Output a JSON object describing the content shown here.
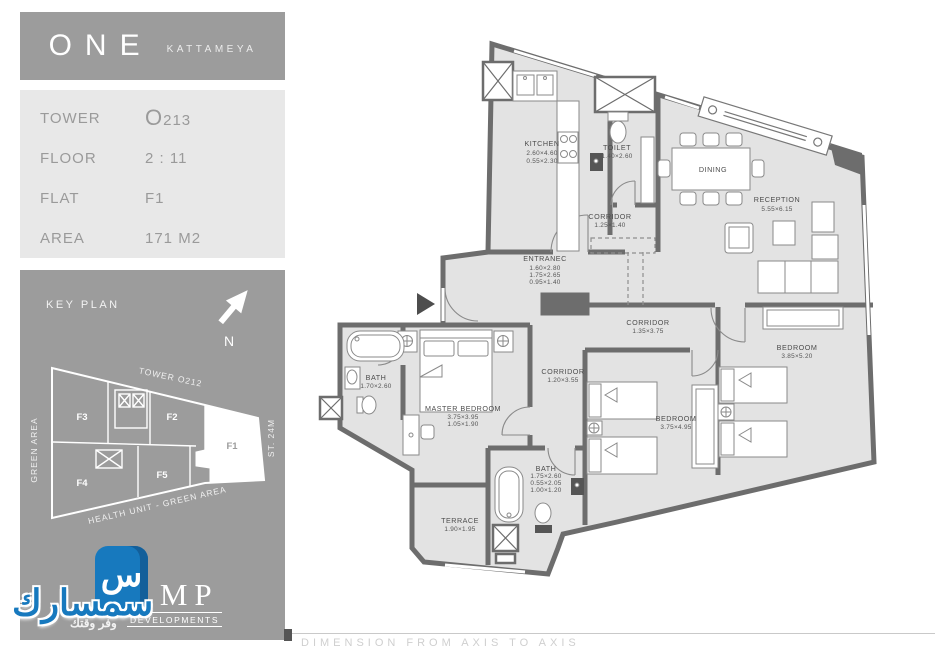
{
  "brand": {
    "title": "ONE",
    "subtitle": "KATTAMEYA"
  },
  "info": {
    "rows": [
      {
        "label": "TOWER",
        "value": "O213"
      },
      {
        "label": "FLOOR",
        "value": "2  :  11"
      },
      {
        "label": "FLAT",
        "value": "F1"
      },
      {
        "label": "AREA",
        "value": "171  M2"
      }
    ]
  },
  "key_plan": {
    "title": "KEY PLAN",
    "north": "N",
    "labels": {
      "top": "TOWER  O212",
      "left": "GREEN  AREA",
      "right": "ST.  24M",
      "bottom": "HEALTH  UNIT  -  GREEN  AREA"
    },
    "flats": [
      "F3",
      "F2",
      "F1",
      "F4",
      "F5"
    ],
    "highlighted_flat": "F1"
  },
  "floor_plan": {
    "rooms": [
      {
        "name": "KITCHEN",
        "dims": [
          "2.60×4.60",
          "0.55×2.30"
        ]
      },
      {
        "name": "TOILET",
        "dims": [
          "1.40×2.60"
        ]
      },
      {
        "name": "CORRIDOR",
        "dims": [
          "1.25×1.40"
        ]
      },
      {
        "name": "DINING",
        "dims": []
      },
      {
        "name": "RECEPTION",
        "dims": [
          "5.55×6.15"
        ]
      },
      {
        "name": "ENTRANEC",
        "dims": [
          "1.60×2.80",
          "1.75×2.65",
          "0.95×1.40"
        ]
      },
      {
        "name": "CORRIDOR",
        "dims": [
          "1.35×3.75"
        ]
      },
      {
        "name": "CORRIDOR",
        "dims": [
          "1.20×3.55"
        ]
      },
      {
        "name": "BATH",
        "dims": [
          "1.70×2.60"
        ]
      },
      {
        "name": "MASTER  BEDROOM",
        "dims": [
          "3.75×3.95",
          "1.05×1.90"
        ]
      },
      {
        "name": "BEDROOM",
        "dims": [
          "3.75×4.95"
        ]
      },
      {
        "name": "BEDROOM",
        "dims": [
          "3.85×5.20"
        ]
      },
      {
        "name": "BATH",
        "dims": [
          "1.75×2.60",
          "0.55×2.05",
          "1.00×1.20"
        ]
      },
      {
        "name": "TERRACE",
        "dims": [
          "1.90×1.95"
        ]
      }
    ]
  },
  "footer": {
    "note": "DIMENSION   FROM   AXIS   TO   AXIS"
  },
  "watermark": {
    "name_ar": "سمسارك",
    "tagline_ar": "وفر وقتك",
    "brand": "AMP",
    "brand_sub": "DEVELOPMENTS",
    "icon_glyph": "س"
  },
  "colors": {
    "panel_gray": "#9c9c9c",
    "panel_light": "#e8e8e8",
    "wall": "#6d6d6d",
    "room_fill": "#e3e3e3",
    "logo_blue": "#1779be"
  }
}
